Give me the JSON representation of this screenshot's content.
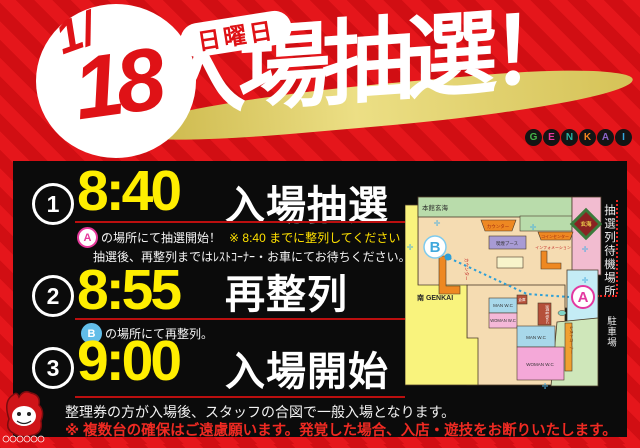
{
  "poster": {
    "date": {
      "month": "1/",
      "day": "18",
      "weekday": "日曜日"
    },
    "title": "入場抽選！",
    "brand_logo": {
      "letters": [
        "G",
        "E",
        "N",
        "K",
        "A",
        "I"
      ]
    },
    "schedule": [
      {
        "number": "1",
        "time": "8:40",
        "label": "入場抽選",
        "marker": "A",
        "note": "の場所にて抽選開始！",
        "note_em": "※ 8:40 までに整列してください",
        "note2": "抽選後、再整列まではﾚｽﾄｺｰﾅｰ・お車にてお待ちください。"
      },
      {
        "number": "2",
        "time": "8:55",
        "label": "再整列",
        "marker": "B",
        "note": "の場所にて再整列。"
      },
      {
        "number": "3",
        "time": "9:00",
        "label": "入場開始"
      }
    ],
    "footer": {
      "line1": "整理券の方が入場後、スタッフの合図で一般入場となります。",
      "line2": "※ 複数台の確保はご遠慮願います。発覚した場合、入店・遊技をお断りいたします。"
    },
    "map": {
      "buildings": {
        "main": "本館玄海",
        "south": "南 GENKAI",
        "parking": "駐車場"
      },
      "waiting_area": "抽選列待機場所",
      "emblem": "玄海",
      "markers": {
        "a": "A",
        "b": "B"
      },
      "rooms": {
        "counter_top": "カウンター",
        "smoking_booth": "喫煙ブース",
        "coin_center": "コインセンター",
        "information": "インフォメーション",
        "counter_left": "カウンター",
        "storage": "倉庫",
        "accessible_wc": "身障者用W.C",
        "man_wc_upper": "MAN W.C",
        "woman_wc_upper": "WOMAN W.C",
        "man_wc_lower": "MAN W.C",
        "woman_wc_lower": "WOMAN W.C",
        "rest_corner": "レストコーナー"
      }
    },
    "colors": {
      "bg_red": "#e5161b",
      "bg_red_dark": "#d10e13",
      "accent_yellow": "#ffee00",
      "underline_red": "#bb0f0f",
      "warning_red": "#ef2a22",
      "marker_a_pink": "#e6399b",
      "marker_b_blue": "#62bde8",
      "gold_swash": "#e9dc80"
    }
  }
}
